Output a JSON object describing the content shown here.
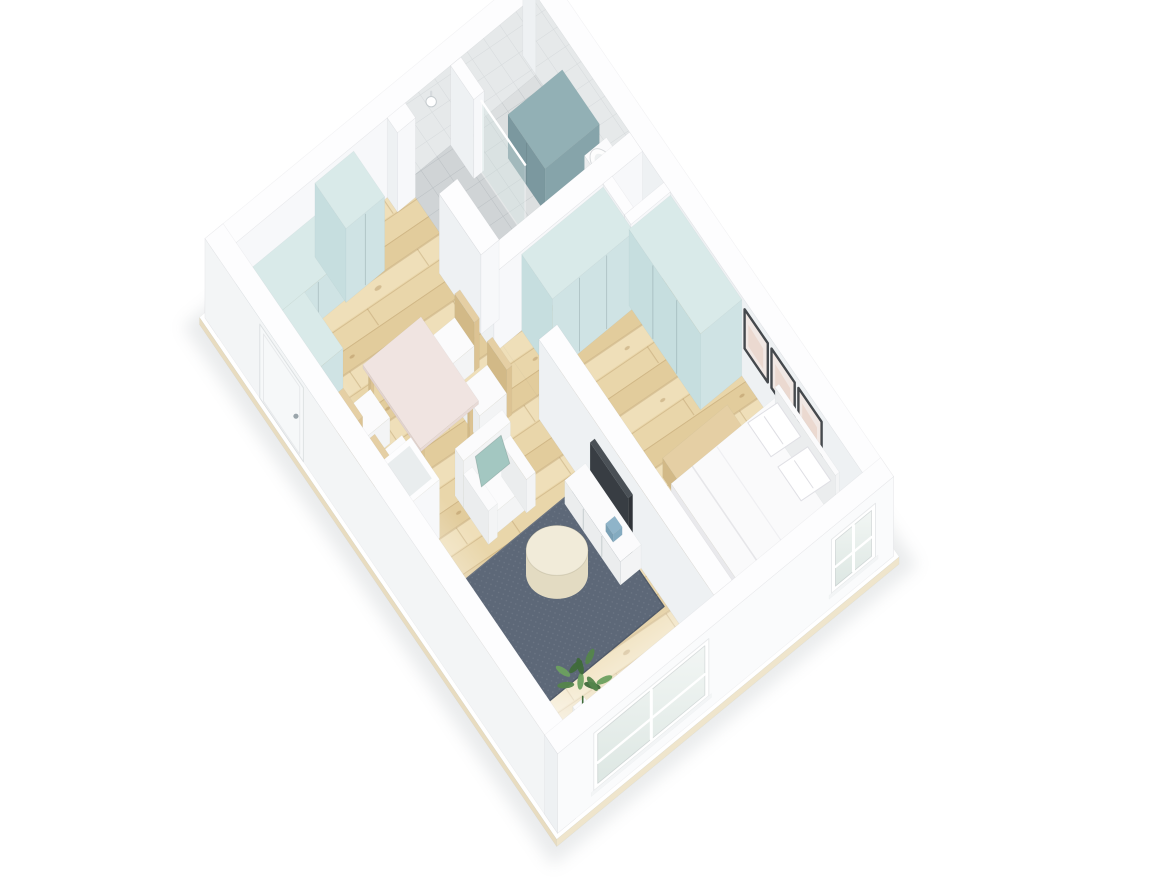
{
  "scene": {
    "units": "meters",
    "building": {
      "width": 5.2,
      "depth": 7.6,
      "wall_height": 1.42,
      "wall_thickness": 0.28
    },
    "palette": {
      "background": "#ffffff",
      "wall_top": "#fdfdfe",
      "wall_left": "#eef1f3",
      "wall_right": "#f7f8fa",
      "slab_left": "#e8dcc0",
      "slab_right": "#efe5cc",
      "wood_base": "#e9d6aa",
      "wood_plank_a": "#efdfb9",
      "wood_plank_b": "#e2cc9c",
      "wood_seam": "rgba(155,120,65,0.28)",
      "tile_base": "#dcdfe0",
      "tile_shower": "#d0d4d6",
      "tile_line": "rgba(110,120,128,0.22)",
      "tile_wall": "#e6e9ea",
      "white_floor": "#fafbfb",
      "mint_top": "#d9eae9",
      "mint_left": "#c6dedf",
      "mint_right": "#cfe3e4",
      "teal_top": "#92b0b5",
      "teal_left": "#7b989f",
      "teal_right": "#86a4aa",
      "white_furn_top": "#fbfbfc",
      "white_furn_left": "#ebedee",
      "white_furn_right": "#f3f4f5",
      "wood_furn_top": "#e5cfa4",
      "wood_furn_left": "#d2b987",
      "wood_furn_right": "#dcc393",
      "dining_top": "#f0e4e1",
      "dining_left": "#e2d3cf",
      "dining_right": "#e8dad6",
      "tv_top": "#4a5056",
      "tv_left": "#383d43",
      "tv_right": "#2f3338",
      "blue_top": "#8fb4c9",
      "blue_left": "#7aa0b5",
      "blue_right": "#84abc0",
      "bed_top": "#fafafb",
      "bed_left": "#e9e9ec",
      "bed_right": "#f1f1f3",
      "pillow": "#ffffff",
      "pillow_teal": "#a3c7c1",
      "rug": "#5d6878",
      "rug_edge": "#4f5968",
      "frame": "#45494d",
      "art": "#f1e8e4",
      "art_accent": "#e6cabc",
      "glass": "#d9e8e6",
      "window_glass_a": "#f2f6f4",
      "window_glass_b": "#dde7e3",
      "plant_dark": "#3f6b3a",
      "plant_mid": "#54854b",
      "plant_light": "#6ca05f",
      "cream_top": "#f1ebd9",
      "cream_side": "#e3dbc2",
      "shadow": "#c2c7ca"
    },
    "rooms": [
      {
        "id": "living-dining-kitchen",
        "floor": "wood"
      },
      {
        "id": "bathroom",
        "floor": "tile"
      },
      {
        "id": "bedroom",
        "floor": "wood"
      },
      {
        "id": "shaft-niche",
        "floor": "white"
      }
    ],
    "items": [
      {
        "id": "ground-shadow",
        "kind": "shadow"
      },
      {
        "id": "floor-slab",
        "kind": "slab"
      },
      {
        "id": "living-floor",
        "kind": "floor",
        "rect": [
          0.28,
          0.28,
          2.62,
          7.04
        ],
        "mat": "wood"
      },
      {
        "id": "bedroom-floor",
        "kind": "floor",
        "rect": [
          2.76,
          2.58,
          2.16,
          4.74
        ],
        "mat": "wood"
      },
      {
        "id": "bathroom-floor",
        "kind": "floor",
        "rect": [
          2.9,
          0.28,
          2.02,
          2.02
        ],
        "mat": "tile"
      },
      {
        "id": "shower-floor",
        "kind": "floor",
        "rect": [
          2.9,
          0.28,
          0.82,
          1.44
        ],
        "mat": "showertile"
      },
      {
        "id": "niche-floor",
        "kind": "floor",
        "rect": [
          4.45,
          2.58,
          0.47,
          0.46
        ],
        "mat": "white"
      },
      {
        "id": "floor-fade-left",
        "kind": "fade",
        "rect": [
          0.28,
          0.28,
          2.62,
          7.04
        ],
        "from": [
          0.28,
          4.0
        ],
        "to": [
          1.18,
          4.0
        ],
        "opacity": 0.55
      },
      {
        "id": "floor-fade-front",
        "kind": "fade",
        "rect": [
          0.28,
          0.28,
          2.62,
          7.04
        ],
        "from": [
          1.4,
          7.32
        ],
        "to": [
          1.4,
          6.0
        ],
        "opacity": 0.92
      },
      {
        "id": "floor-fade-bedroom",
        "kind": "fade",
        "rect": [
          2.76,
          2.58,
          2.16,
          4.74
        ],
        "from": [
          3.9,
          7.32
        ],
        "to": [
          3.9,
          6.45
        ],
        "opacity": 0.8
      },
      {
        "id": "rug",
        "kind": "rug",
        "rect": [
          0.75,
          4.5,
          1.83,
          1.8
        ]
      },
      {
        "id": "outer-wall-north",
        "kind": "wall",
        "rect": [
          0,
          0,
          5.2,
          0.28
        ],
        "h": 1.42,
        "faces": {
          "left": "#f2f4f5"
        }
      },
      {
        "id": "bathroom-wall-tiles-north",
        "kind": "tileface",
        "plane": "V",
        "y": 0.28,
        "x0": 2.9,
        "x1": 4.92
      },
      {
        "id": "shower-head",
        "kind": "showerhead",
        "x": 3.3
      },
      {
        "id": "outer-wall-east",
        "kind": "wall",
        "rect": [
          4.92,
          0,
          0.28,
          7.6
        ],
        "h": 1.42
      },
      {
        "id": "bathroom-wall-tiles-east",
        "kind": "tileface",
        "plane": "U",
        "x": 4.92,
        "y0": 0.28,
        "y1": 2.3
      },
      {
        "id": "picture-frames",
        "kind": "pictures",
        "x": 4.92,
        "ys": [
          4.78,
          5.36,
          5.94
        ],
        "w": 0.5,
        "h0": 0.56,
        "h1": 1.26
      },
      {
        "id": "kitchen-base-cabinet",
        "kind": "box",
        "rect": [
          0.28,
          0.28,
          1.22,
          0.64
        ],
        "h": 0.74,
        "mat": "mint",
        "seamsRight": 2
      },
      {
        "id": "kitchen-tall-cabinet",
        "kind": "box",
        "rect": [
          1.5,
          0.28,
          0.6,
          0.67
        ],
        "h": 1.32,
        "mat": "mint",
        "seamsRight": 1
      },
      {
        "id": "kitchen-return-cabinet",
        "kind": "box",
        "rect": [
          0.28,
          0.92,
          0.6,
          0.83
        ],
        "h": 0.74,
        "mat": "mint"
      },
      {
        "id": "shower-stub-wall",
        "kind": "wall",
        "rect": [
          3.6,
          0.28,
          0.16,
          0.5
        ],
        "h": 1.42
      },
      {
        "id": "washer-unit",
        "kind": "box",
        "rect": [
          4.08,
          0.85,
          0.84,
          0.8
        ],
        "h": 0.78,
        "mat": "teal",
        "seamsLeft": 1
      },
      {
        "id": "bathroom-sink",
        "kind": "sink"
      },
      {
        "id": "toilet",
        "kind": "toilet"
      },
      {
        "id": "shower-glass",
        "kind": "glass"
      },
      {
        "id": "bathroom-south-wall",
        "kind": "wall",
        "rect": [
          2.62,
          2.3,
          2.3,
          0.28
        ],
        "h": 1.42
      },
      {
        "id": "niche-wall-west",
        "kind": "wall",
        "rect": [
          4.31,
          2.58,
          0.14,
          0.46
        ],
        "h": 1.42
      },
      {
        "id": "niche-wall-south",
        "kind": "wall",
        "rect": [
          4.31,
          3.04,
          0.61,
          0.14
        ],
        "h": 1.42
      },
      {
        "id": "wardrobe-long",
        "kind": "box",
        "rect": [
          3.05,
          2.58,
          1.26,
          0.66
        ],
        "h": 1.36,
        "mat": "mint",
        "seamsRight": 2
      },
      {
        "id": "wardrobe-corner",
        "kind": "box",
        "rect": [
          4.28,
          3.18,
          0.64,
          1.54
        ],
        "h": 1.36,
        "mat": "mint",
        "seamsLeft": 2
      },
      {
        "id": "bedroom-bench",
        "kind": "box",
        "rect": [
          3.45,
          5.06,
          1.0,
          0.34
        ],
        "h": 0.34,
        "mat": "wood_furn"
      },
      {
        "id": "bed",
        "kind": "bed",
        "rect": [
          3.3,
          5.45,
          1.62,
          1.45
        ]
      },
      {
        "id": "radiator",
        "kind": "radiator",
        "rect": [
          2.9,
          4.85,
          0.13,
          1.5
        ],
        "h": 0.95
      },
      {
        "id": "partition-wall-north",
        "kind": "wall",
        "rect": [
          2.62,
          0.28,
          0.28,
          0.22
        ],
        "h": 1.42
      },
      {
        "id": "partition-wall-mid",
        "kind": "wall",
        "rect": [
          2.62,
          1.4,
          0.28,
          0.9
        ],
        "h": 1.42
      },
      {
        "id": "partition-wall-south",
        "kind": "wall",
        "rect": [
          2.62,
          3.55,
          0.28,
          3.77
        ],
        "h": 1.42
      },
      {
        "id": "tv",
        "kind": "box",
        "rect": [
          2.55,
          4.75,
          0.07,
          0.82
        ],
        "h": 1.1,
        "mat": "tv"
      },
      {
        "id": "tv-sideboard",
        "kind": "box",
        "rect": [
          2.3,
          4.55,
          0.32,
          1.2
        ],
        "h": 0.42,
        "mat": "white_furn",
        "seamsLeft": 2
      },
      {
        "id": "sideboard-decor",
        "kind": "box",
        "rect": [
          2.36,
          5.35,
          0.14,
          0.16
        ],
        "h": 0.14,
        "z0": 0.42,
        "mat": "blue"
      },
      {
        "id": "dining-chair-1",
        "kind": "chair",
        "x": 1.88,
        "y": 2.18,
        "back": "right"
      },
      {
        "id": "dining-chair-2",
        "kind": "chair",
        "x": 1.88,
        "y": 2.88,
        "back": "right"
      },
      {
        "id": "dining-table",
        "kind": "table",
        "rect": [
          0.95,
          2.08,
          0.9,
          1.24
        ]
      },
      {
        "id": "dining-chair-3",
        "kind": "chair",
        "x": 0.56,
        "y": 2.2,
        "back": "left"
      },
      {
        "id": "dining-chair-4",
        "kind": "chair",
        "x": 0.56,
        "y": 2.88,
        "back": "left"
      },
      {
        "id": "armchair",
        "kind": "armchair"
      },
      {
        "id": "utility-column",
        "kind": "shaftbox",
        "rect": [
          0.28,
          3.28,
          0.55,
          0.62
        ],
        "h": 1.05
      },
      {
        "id": "coffee-table",
        "kind": "cylinder",
        "c": [
          1.75,
          5.15
        ],
        "r": 0.39,
        "h": 0.42
      },
      {
        "id": "plant",
        "kind": "plant",
        "c": [
          1.02,
          6.72
        ]
      },
      {
        "id": "window-bench",
        "kind": "box",
        "rect": [
          0.7,
          7.02,
          1.5,
          0.3
        ],
        "h": 0.45,
        "mat": "white_furn"
      },
      {
        "id": "outer-wall-west",
        "kind": "wall",
        "rect": [
          0,
          0,
          0.28,
          7.6
        ],
        "h": 1.42,
        "faces": {
          "left": "#f3f5f6"
        }
      },
      {
        "id": "entry-door",
        "kind": "door",
        "y0": 1.18,
        "y1": 2.12,
        "h": 1.32
      },
      {
        "id": "outer-wall-south",
        "kind": "wall",
        "rect": [
          0,
          7.32,
          5.2,
          0.28
        ],
        "h": 1.42,
        "faces": {
          "right": "#fafbfc"
        }
      },
      {
        "id": "living-window",
        "kind": "window",
        "x0": 0.62,
        "x1": 2.28,
        "h0": 0.3,
        "h1": 1.18
      },
      {
        "id": "bedroom-window",
        "kind": "window",
        "x0": 4.3,
        "x1": 4.86,
        "h0": 0.32,
        "h1": 1.14
      }
    ]
  }
}
